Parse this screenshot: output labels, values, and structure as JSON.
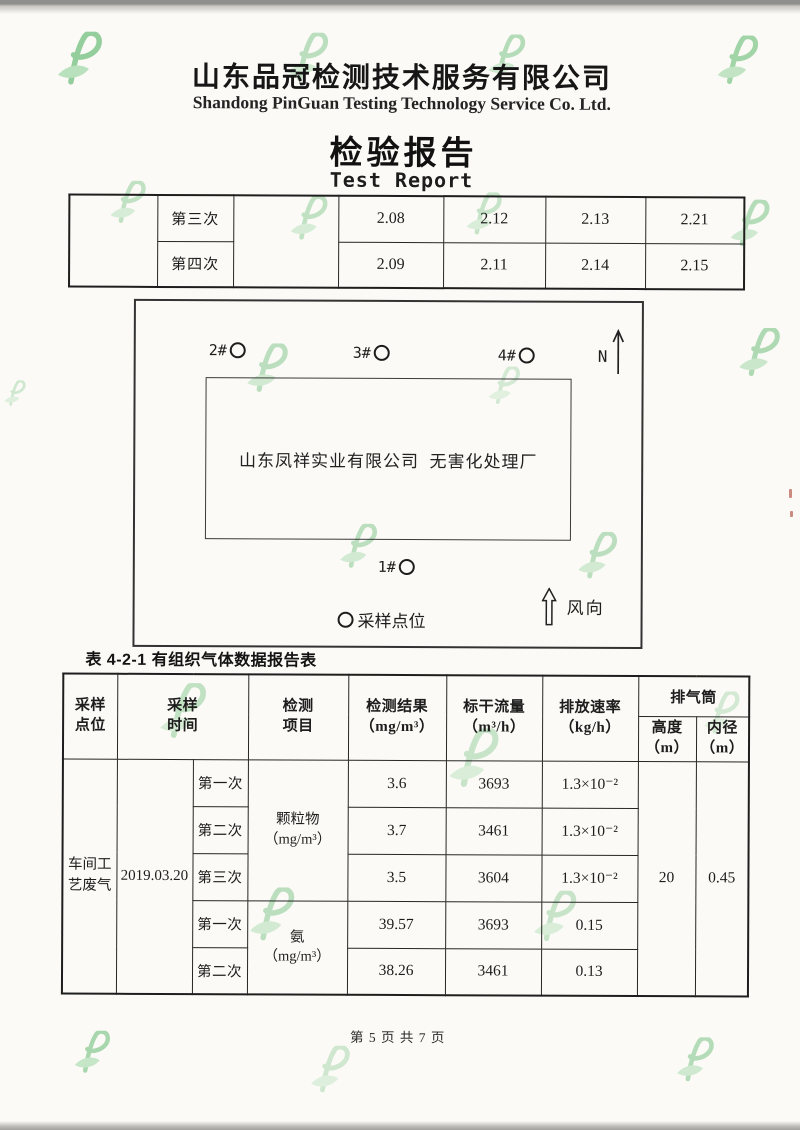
{
  "colors": {
    "watermark_green_dark": "#7cc487",
    "watermark_green_light": "#aadcb0",
    "ink": "#1e1e1e",
    "paper": "#fbfaf6"
  },
  "header": {
    "company_cn": "山东品冠检测技术服务有限公司",
    "company_en": "Shandong PinGuan Testing Technology Service Co. Ltd.",
    "title_cn": "检验报告",
    "title_en": "Test Report"
  },
  "top_table": {
    "rows": [
      {
        "label": "第三次",
        "values": [
          "2.08",
          "2.12",
          "2.13",
          "2.21"
        ]
      },
      {
        "label": "第四次",
        "values": [
          "2.09",
          "2.11",
          "2.14",
          "2.15"
        ]
      }
    ]
  },
  "diagram": {
    "points": [
      {
        "label": "2#"
      },
      {
        "label": "3#"
      },
      {
        "label": "4#"
      },
      {
        "label": "1#"
      }
    ],
    "north_label": "N",
    "site_label": "山东凤祥实业有限公司  无害化处理厂",
    "legend_label": "采样点位",
    "wind_label": "风向"
  },
  "main_table": {
    "caption": "表 4-2-1 有组织气体数据报告表",
    "headers": {
      "sample_point": "采样\n点位",
      "sample_time": "采样\n时间",
      "item": "检测\n项目",
      "result": "检测结果\n（mg/m³）",
      "flow": "标干流量\n（m³/h）",
      "rate": "排放速率\n（kg/h）",
      "stack": "排气筒",
      "height": "高度\n（m）",
      "diameter": "内径\n（m）"
    },
    "body": {
      "sample_point": "车间工艺废气",
      "date": "2019.03.20",
      "groups": [
        {
          "item": "颗粒物\n（mg/m³）",
          "runs": [
            {
              "run": "第一次",
              "result": "3.6",
              "flow": "3693",
              "rate": "1.3×10⁻²"
            },
            {
              "run": "第二次",
              "result": "3.7",
              "flow": "3461",
              "rate": "1.3×10⁻²"
            },
            {
              "run": "第三次",
              "result": "3.5",
              "flow": "3604",
              "rate": "1.3×10⁻²"
            }
          ]
        },
        {
          "item": "氨\n（mg/m³）",
          "runs": [
            {
              "run": "第一次",
              "result": "39.57",
              "flow": "3693",
              "rate": "0.15"
            },
            {
              "run": "第二次",
              "result": "38.26",
              "flow": "3461",
              "rate": "0.13"
            }
          ]
        }
      ],
      "stack_height": "20",
      "stack_diameter": "0.45"
    }
  },
  "footer": {
    "page_info": "第 5 页 共 7 页"
  }
}
